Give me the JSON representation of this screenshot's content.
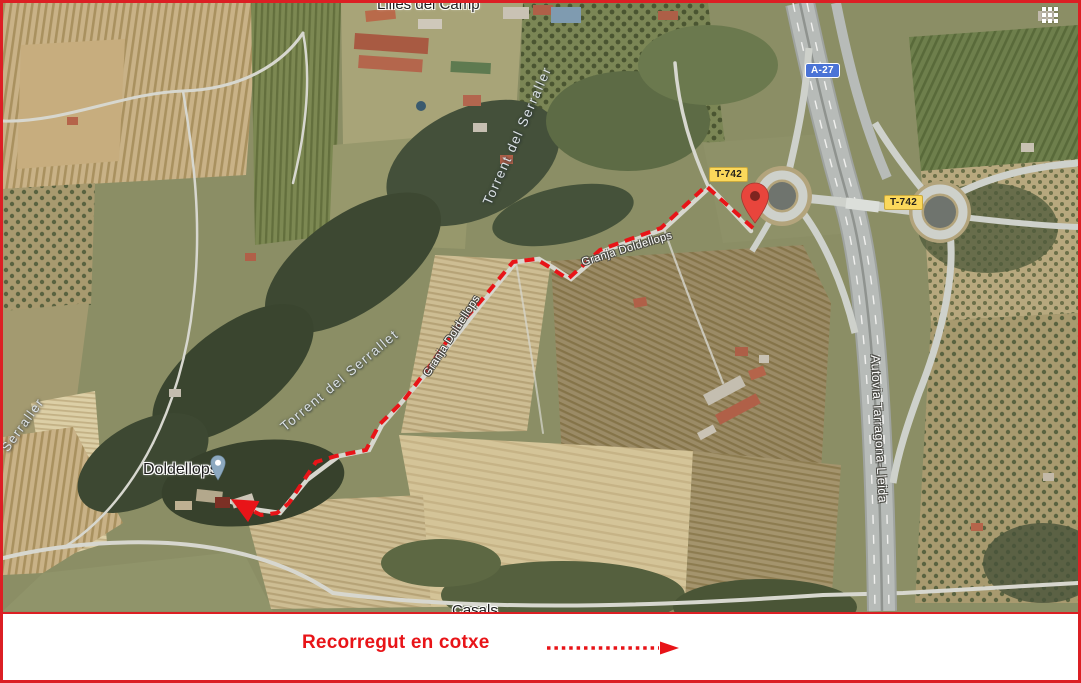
{
  "map": {
    "place_labels": {
      "top_place": "Lilles del Camp",
      "doldellops": "Doldellops",
      "bottom_partial": "Casals"
    },
    "water_labels": {
      "torrent_serraller": "Torrent del Serraller",
      "torrent_serrallet": "Torrent del Serrallet",
      "serraller": "Serraller"
    },
    "road_labels": {
      "autovia": "Autovia Tarragona-Lleida",
      "granja_upper": "Granja Doldellops",
      "granja_lower": "Granja Doldellops"
    },
    "road_badges": {
      "a27": "A-27",
      "t742_west": "T-742",
      "t742_east": "T-742"
    },
    "icons": {
      "apps_grid": "apps-grid-icon",
      "destination_marker": "red-location-marker-icon",
      "poi_pin": "place-pin-icon"
    },
    "colors": {
      "route_red": "#e81418",
      "border_red": "#dc1f24",
      "badge_yellow_bg": "#fbd85b",
      "badge_blue_bg": "#4a73d6",
      "marker_red": "#e8453c",
      "poi_pin_blue": "#8da9c0"
    },
    "route_points": [
      [
        750,
        225
      ],
      [
        703,
        183
      ],
      [
        658,
        225
      ],
      [
        597,
        247
      ],
      [
        565,
        276
      ],
      [
        548,
        265
      ],
      [
        533,
        256
      ],
      [
        510,
        259
      ],
      [
        477,
        299
      ],
      [
        451,
        328
      ],
      [
        426,
        364
      ],
      [
        401,
        397
      ],
      [
        376,
        422
      ],
      [
        363,
        447
      ],
      [
        333,
        453
      ],
      [
        313,
        459
      ],
      [
        301,
        477
      ],
      [
        286,
        500
      ],
      [
        274,
        510
      ],
      [
        258,
        512
      ],
      [
        246,
        506
      ],
      [
        235,
        500
      ]
    ]
  },
  "legend": {
    "label": "Recorregut en cotxe"
  }
}
